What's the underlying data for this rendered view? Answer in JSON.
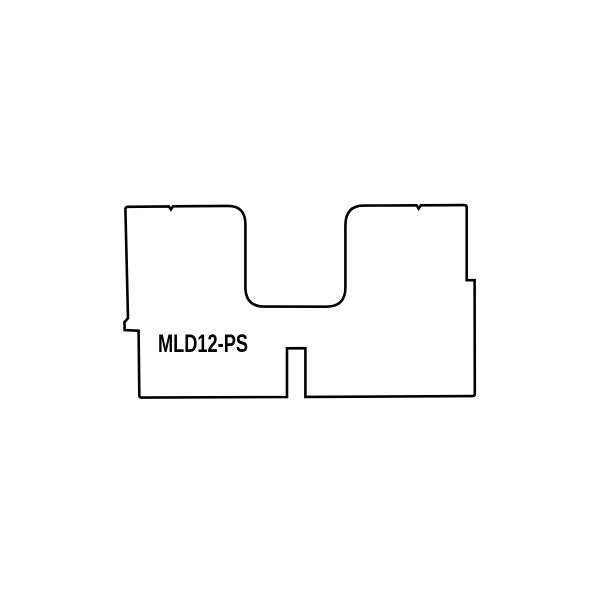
{
  "page": {
    "background_color": "#ffffff"
  },
  "drawing": {
    "part_label": "MLD12-PS",
    "line_color": "#000000",
    "fill_color": "#ffffff",
    "outline_path": "M 128.2 206.8 L 168.8 206.4 l 2.1 3.1 l 2.2 -3.2 L 228 205.9 Q 245.4 205.8 245.4 224.5 L 245.4 287 Q 245.4 306.6 264.5 306.6 L 326 306.7 Q 345.4 306.8 345.4 287.5 L 345.4 225.5 Q 345.4 205.7 363.5 205.6 L 416.6 205.3 l 2.1 3.3 l 2.2 -3.3 L 464.3 205.1 Q 466.7 205.1 466.7 207.5 L 466.7 280.2 L 474.6 280.2 L 474.8 393.8 Q 474.8 396.1 472.5 396.1 L 305.4 396.9 L 305.4 348.2 L 287 348.3 L 287 397 L 141.6 397.6 Q 139.3 397.6 139.3 395.3 L 138.6 330.7 L 124.6 330.1 L 124.5 322 L 128 318.2 L 125.4 209.6 Q 125.3 206.8 128.2 206.8 Z"
  }
}
